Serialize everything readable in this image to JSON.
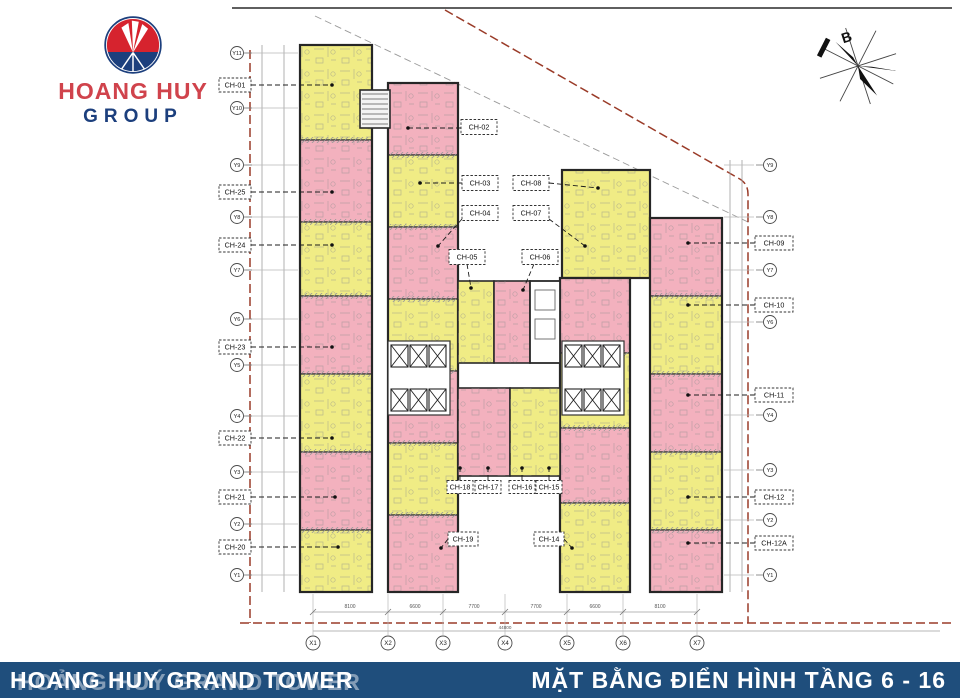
{
  "logo": {
    "name_line1": "HOANG HUY",
    "name_line2": "GROUP"
  },
  "compass": {
    "label": "B"
  },
  "footer": {
    "left_title": "HOANG HUY GRAND TOWER",
    "left_title_ghost": "HOẢNG HUÝ GRAND TOWER",
    "right_title": "MẶT BẰNG ĐIỂN HÌNH TẦNG 6 - 16"
  },
  "palette": {
    "pink": "#f3b1be",
    "yellow": "#f0ec85",
    "wall": "#3a3a3a",
    "boundary_red": "#9a3b28",
    "grid_gray": "#b8b8b8",
    "footer_blue": "#1f4e7c",
    "logo_red": "#d6232e",
    "logo_blue": "#1c3f7d"
  },
  "plan": {
    "unit_labels": [
      {
        "t": "CH-01",
        "box": [
          235,
          85,
          32,
          14
        ],
        "lead": [
          251,
          85,
          332,
          85
        ]
      },
      {
        "t": "CH-25",
        "box": [
          235,
          192,
          32,
          14
        ],
        "lead": [
          251,
          192,
          332,
          192
        ]
      },
      {
        "t": "CH-24",
        "box": [
          235,
          245,
          32,
          14
        ],
        "lead": [
          251,
          245,
          332,
          245
        ]
      },
      {
        "t": "CH-23",
        "box": [
          235,
          347,
          32,
          14
        ],
        "lead": [
          251,
          347,
          332,
          347
        ]
      },
      {
        "t": "CH-22",
        "box": [
          235,
          438,
          32,
          14
        ],
        "lead": [
          251,
          438,
          332,
          438
        ]
      },
      {
        "t": "CH-21",
        "box": [
          235,
          497,
          32,
          14
        ],
        "lead": [
          251,
          497,
          335,
          497
        ]
      },
      {
        "t": "CH-20",
        "box": [
          235,
          547,
          32,
          14
        ],
        "lead": [
          251,
          547,
          338,
          547
        ]
      },
      {
        "t": "CH-09",
        "box": [
          774,
          243,
          38,
          14
        ],
        "lead": [
          755,
          243,
          688,
          243
        ]
      },
      {
        "t": "CH-10",
        "box": [
          774,
          305,
          38,
          14
        ],
        "lead": [
          755,
          305,
          688,
          305
        ]
      },
      {
        "t": "CH-11",
        "box": [
          774,
          395,
          38,
          14
        ],
        "lead": [
          755,
          395,
          688,
          395
        ]
      },
      {
        "t": "CH-12",
        "box": [
          774,
          497,
          38,
          14
        ],
        "lead": [
          755,
          497,
          688,
          497
        ]
      },
      {
        "t": "CH-12A",
        "box": [
          774,
          543,
          38,
          14
        ],
        "lead": [
          755,
          543,
          688,
          543
        ]
      },
      {
        "t": "CH-02",
        "box": [
          479,
          127,
          36,
          15
        ],
        "lead": [
          461,
          128,
          408,
          128
        ]
      },
      {
        "t": "CH-03",
        "box": [
          480,
          183,
          36,
          15
        ],
        "lead": [
          462,
          183,
          420,
          183
        ]
      },
      {
        "t": "CH-08",
        "box": [
          531,
          183,
          36,
          15
        ],
        "lead": [
          549,
          183,
          598,
          188
        ]
      },
      {
        "t": "CH-04",
        "box": [
          480,
          213,
          36,
          15
        ],
        "lead": [
          462,
          219,
          438,
          246
        ]
      },
      {
        "t": "CH-07",
        "box": [
          531,
          213,
          36,
          15
        ],
        "lead": [
          549,
          219,
          585,
          246
        ]
      },
      {
        "t": "CH-05",
        "box": [
          467,
          257,
          36,
          15
        ],
        "lead": [
          467,
          264,
          471,
          288
        ]
      },
      {
        "t": "CH-06",
        "box": [
          540,
          257,
          36,
          15
        ],
        "lead": [
          534,
          264,
          523,
          290
        ]
      },
      {
        "t": "CH-18",
        "box": [
          460,
          487,
          26,
          13
        ],
        "lead": [
          460,
          480,
          460,
          468
        ]
      },
      {
        "t": "CH-17",
        "box": [
          488,
          487,
          26,
          13
        ],
        "lead": [
          488,
          480,
          488,
          468
        ]
      },
      {
        "t": "CH-16",
        "box": [
          522,
          487,
          26,
          13
        ],
        "lead": [
          522,
          480,
          522,
          468
        ]
      },
      {
        "t": "CH-15",
        "box": [
          549,
          487,
          26,
          13
        ],
        "lead": [
          549,
          480,
          549,
          468
        ]
      },
      {
        "t": "CH-19",
        "box": [
          463,
          539,
          30,
          14
        ],
        "lead": [
          448,
          539,
          441,
          548
        ]
      },
      {
        "t": "CH-14",
        "box": [
          549,
          539,
          30,
          14
        ],
        "lead": [
          564,
          539,
          572,
          548
        ]
      }
    ],
    "left_axis": [
      {
        "t": "Y11",
        "y": 53
      },
      {
        "t": "Y10",
        "y": 108
      },
      {
        "t": "Y9",
        "y": 165
      },
      {
        "t": "Y8",
        "y": 217
      },
      {
        "t": "Y7",
        "y": 270
      },
      {
        "t": "Y6",
        "y": 319
      },
      {
        "t": "Y5",
        "y": 365
      },
      {
        "t": "Y4",
        "y": 416
      },
      {
        "t": "Y3",
        "y": 472
      },
      {
        "t": "Y2",
        "y": 524
      },
      {
        "t": "Y1",
        "y": 575
      }
    ],
    "right_axis": [
      {
        "t": "Y9",
        "y": 165
      },
      {
        "t": "Y8",
        "y": 217
      },
      {
        "t": "Y7",
        "y": 270
      },
      {
        "t": "Y6",
        "y": 322
      },
      {
        "t": "Y4",
        "y": 415
      },
      {
        "t": "Y3",
        "y": 470
      },
      {
        "t": "Y2",
        "y": 520
      },
      {
        "t": "Y1",
        "y": 575
      }
    ],
    "bottom_axis": [
      {
        "t": "X1",
        "x": 313
      },
      {
        "t": "X2",
        "x": 388
      },
      {
        "t": "X3",
        "x": 443
      },
      {
        "t": "X4",
        "x": 505
      },
      {
        "t": "X5",
        "x": 567
      },
      {
        "t": "X6",
        "x": 623
      },
      {
        "t": "X7",
        "x": 697
      }
    ],
    "bottom_dims": [
      {
        "x": 350,
        "t": "8100"
      },
      {
        "x": 415,
        "t": "6600"
      },
      {
        "x": 474,
        "t": "7700"
      },
      {
        "x": 536,
        "t": "7700"
      },
      {
        "x": 595,
        "t": "6600"
      },
      {
        "x": 660,
        "t": "8100"
      }
    ],
    "bottom_total": {
      "x": 505,
      "y": 629,
      "t": "44800"
    },
    "strips": [
      {
        "x": 300,
        "w": 72,
        "y0": 45,
        "blocks": [
          [
            "y",
            95
          ],
          [
            "p",
            82
          ],
          [
            "y",
            74
          ],
          [
            "p",
            78
          ],
          [
            "y",
            78
          ],
          [
            "p",
            78
          ],
          [
            "y",
            62
          ]
        ]
      },
      {
        "x": 388,
        "w": 70,
        "y0": 83,
        "blocks": [
          [
            "p",
            72
          ],
          [
            "y",
            72
          ],
          [
            "p",
            72
          ],
          [
            "y",
            72
          ],
          [
            "p",
            72
          ],
          [
            "y",
            72
          ],
          [
            "p",
            77
          ]
        ]
      },
      {
        "x": 562,
        "w": 88,
        "y0": 170,
        "blocks": [
          [
            "y",
            108
          ]
        ]
      },
      {
        "x": 560,
        "w": 70,
        "y0": 278,
        "blocks": [
          [
            "p",
            75
          ],
          [
            "y",
            75
          ],
          [
            "p",
            75
          ],
          [
            "y",
            89
          ]
        ]
      },
      {
        "x": 650,
        "w": 72,
        "y0": 218,
        "blocks": [
          [
            "p",
            78
          ],
          [
            "y",
            78
          ],
          [
            "p",
            78
          ],
          [
            "y",
            78
          ],
          [
            "p",
            62
          ]
        ]
      }
    ],
    "center_rects": [
      {
        "x": 458,
        "y": 281,
        "w": 36,
        "h": 82,
        "c": "y"
      },
      {
        "x": 494,
        "y": 281,
        "w": 36,
        "h": 82,
        "c": "p"
      },
      {
        "x": 530,
        "y": 281,
        "w": 30,
        "h": 82,
        "c": "core"
      },
      {
        "x": 458,
        "y": 388,
        "w": 52,
        "h": 88,
        "c": "p"
      },
      {
        "x": 510,
        "y": 388,
        "w": 50,
        "h": 88,
        "c": "y"
      }
    ],
    "elevator_banks": [
      {
        "x": 391,
        "y": 345
      },
      {
        "x": 565,
        "y": 345
      }
    ],
    "stair": {
      "x": 360,
      "y": 90,
      "w": 30,
      "h": 38
    }
  }
}
